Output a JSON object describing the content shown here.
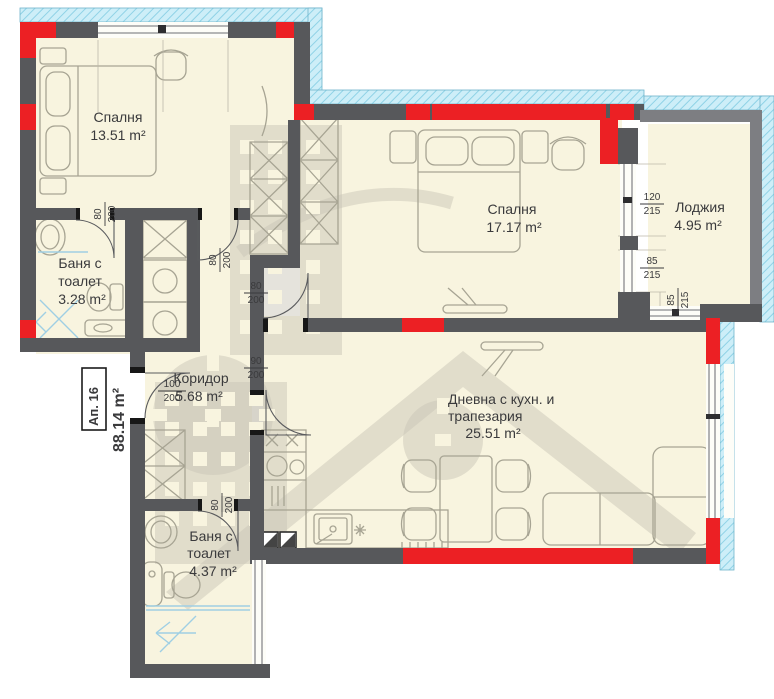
{
  "apartment": {
    "label": "Ап. 16",
    "area": "88.14 m²"
  },
  "rooms": {
    "bedroom1": {
      "name": "Спалня",
      "area": "13.51 m²"
    },
    "bedroom2": {
      "name": "Спалня",
      "area": "17.17 m²"
    },
    "loggia": {
      "name": "Лоджия",
      "area": "4.95 m²"
    },
    "bath1": {
      "name1": "Баня с",
      "name2": "тоалет",
      "area": "3.28 m²"
    },
    "corridor": {
      "name": "Коридор",
      "area": "5.68 m²"
    },
    "living": {
      "name1": "Дневна с кухн. и",
      "name2": "трапезария",
      "area": "25.51 m²"
    },
    "bath2": {
      "name1": "Баня с",
      "name2": "тоалет",
      "area": "4.37 m²"
    }
  },
  "openings": {
    "bath1_door": {
      "w": "80",
      "h": "200"
    },
    "closet_door": {
      "w": "80",
      "h": "200"
    },
    "bedroom2_door": {
      "w": "80",
      "h": "200"
    },
    "living_door": {
      "w": "90",
      "h": "200"
    },
    "entrance_door": {
      "w": "100",
      "h": "200"
    },
    "bath2_door": {
      "w": "80",
      "h": "200"
    },
    "loggia_window_top": {
      "w": "120",
      "h": "215"
    },
    "loggia_window_mid": {
      "w": "85",
      "h": "215"
    },
    "loggia_window_bottom": {
      "w": "85",
      "h": "215"
    }
  },
  "colors": {
    "wall": "#57585b",
    "structure_red": "#ec2024",
    "floor": "#f8f4df",
    "insulation": "#cdeef8",
    "watermark": "#c8c4b5"
  }
}
